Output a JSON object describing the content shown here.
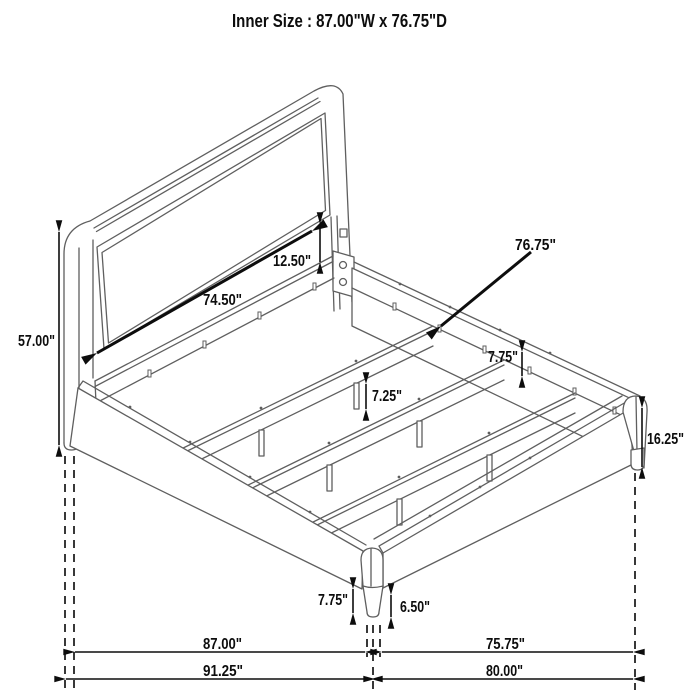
{
  "title": "Inner Size : 87.00\"W x 76.75\"D",
  "dims": {
    "headboard_height": "57.00\"",
    "headboard_width": "74.50\"",
    "panel_gap": "12.50\"",
    "inner_depth": "76.75\"",
    "slat_drop": "7.75\"",
    "support_leg": "7.25\"",
    "rail_height": "16.25\"",
    "front_leg": "7.75\"",
    "front_leg_taper": "6.50\"",
    "floor_width_inner": "87.00\"",
    "floor_depth_inner": "75.75\"",
    "floor_width_overall": "91.25\"",
    "floor_depth_overall": "80.00\""
  },
  "colors": {
    "line_art": "#5f5f5f",
    "annotation": "#0d0d0d",
    "background": "#ffffff"
  }
}
